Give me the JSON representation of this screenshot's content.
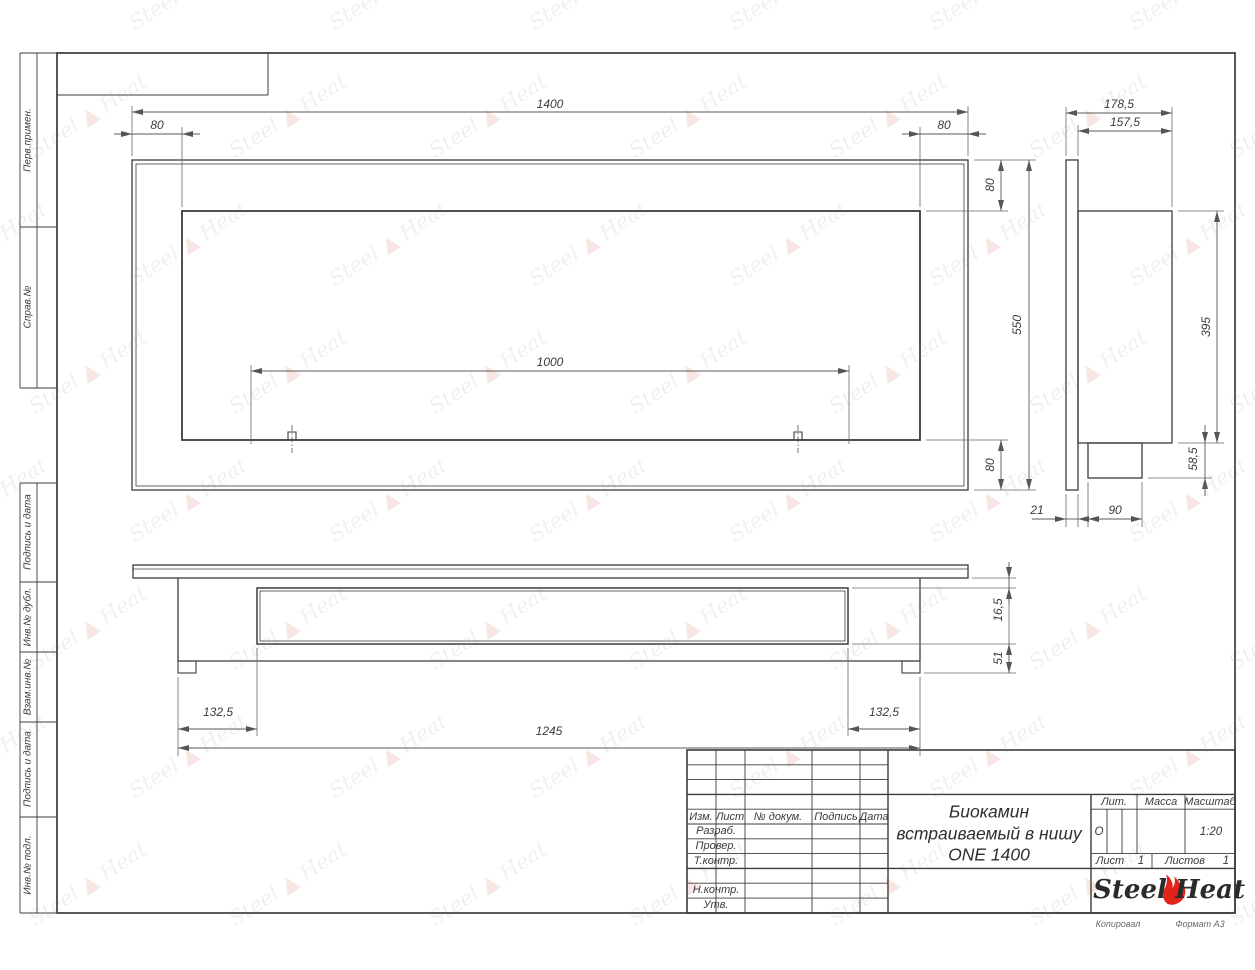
{
  "sheet": {
    "kopiroval": "Копировал",
    "format_note": "Формат А3"
  },
  "margin_labels": [
    "Перв.примен.",
    "Справ.№",
    "Подпись и дата",
    "Инв.№ дубл.",
    "Взам.инв.№",
    "Подпись и дата",
    "Инв.№ подл."
  ],
  "title_block": {
    "header_cols": [
      "Изм.",
      "Лист",
      "№ докум.",
      "Подпись",
      "Дата"
    ],
    "row_labels": [
      "Разраб.",
      "Провер.",
      "Т.контр.",
      "Н.контр.",
      "Утв."
    ],
    "doc_title_lines": [
      "Биокамин",
      "встраиваемый в нишу",
      "ONE 1400"
    ],
    "lit_label": "Лит.",
    "lit_value": "О",
    "mass_label": "Масса",
    "scale_label": "Масштаб",
    "scale_value": "1:20",
    "sheet_label": "Лист",
    "sheet_value": "1",
    "sheets_label": "Листов",
    "sheets_value": "1",
    "brand": {
      "steel": "Steel",
      "heat": "Heat",
      "flame_color": "#e2231a"
    }
  },
  "dimensions": {
    "front_width": "1400",
    "front_left_inset": "80",
    "front_right_inset": "80",
    "front_top_inset": "80",
    "front_height": "550",
    "front_bottom_inset": "80",
    "front_opening": "1000",
    "side_depth_total": "178,5",
    "side_depth_body": "157,5",
    "side_body_height": "395",
    "side_tray_height": "58,5",
    "side_flange_depth": "21",
    "side_tray_depth": "90",
    "bottom_left_inset": "132,5",
    "bottom_body_width": "1245",
    "bottom_right_inset": "132,5",
    "bottom_front_inset": "16,5",
    "bottom_back_inset": "51"
  },
  "watermark": {
    "steel": "Steel",
    "heat": "Heat"
  }
}
